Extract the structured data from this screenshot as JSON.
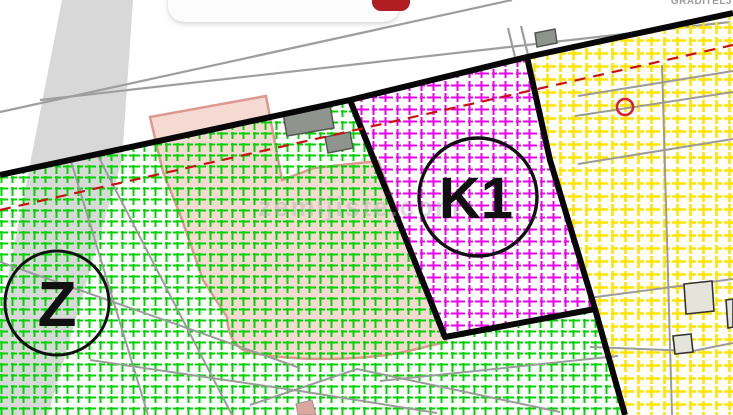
{
  "map": {
    "labels": {
      "zone_z": "Z",
      "zone_k1": "K1",
      "top_right": "GRADITELJ",
      "watermark": "zemljiste.com"
    },
    "colors": {
      "green_hatch": "#00d400",
      "magenta_hatch": "#ee00ee",
      "yellow_hatch": "#ffe400",
      "boundary_black": "#070707",
      "road_line_gray": "#9e9e9e",
      "parcel_gray": "#9b9b9b",
      "road_band_gray": "#d8d8d8",
      "overlay_pink_fill": "#f5dad4",
      "overlay_pink_border": "#dd998f",
      "red_dashed": "#cc1111",
      "marker_red": "#dd2222",
      "building_gray": "#8f948c",
      "building_beige": "#e4e4db",
      "watermark_gray": "#b0b0b0",
      "button_red": "#b01d23"
    }
  }
}
